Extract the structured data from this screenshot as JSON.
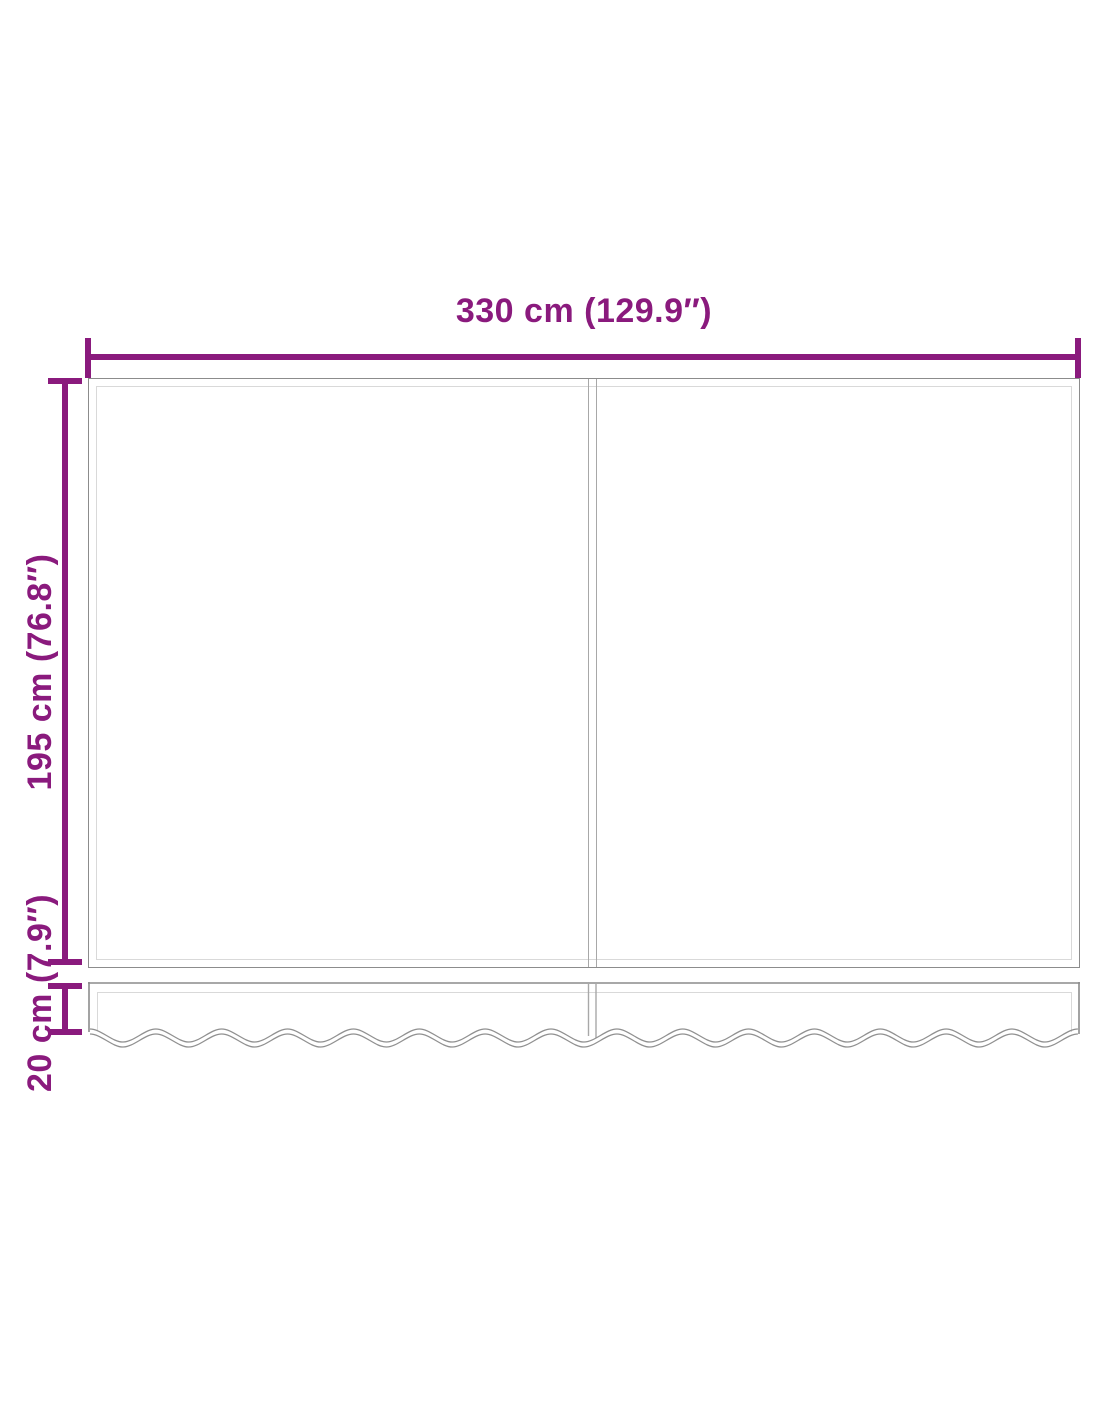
{
  "diagram": {
    "labels": {
      "width": "330 cm (129.9″)",
      "height": "195 cm (76.8″)",
      "valance_height": "20 cm (7.9″)"
    },
    "colors": {
      "dimension": "#8a1a7d",
      "outline_dark": "#8c8c8c",
      "outline_light": "#d9d9d9",
      "seam": "#a8a8a8",
      "background": "#ffffff"
    },
    "structure": {
      "panels": 2,
      "valance": {
        "wave_periods": 15,
        "wave_amplitude": 13
      }
    }
  }
}
